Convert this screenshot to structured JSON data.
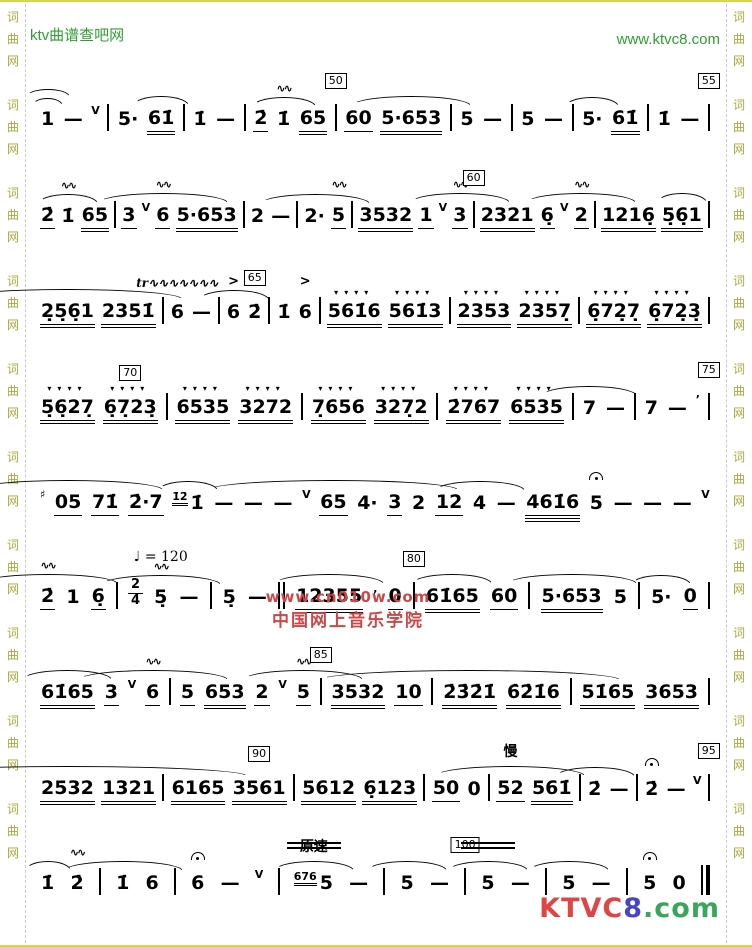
{
  "header": {
    "site_left": "ktv曲谱查吧网",
    "site_right": "www.ktvc8.com",
    "link_color": "#2f9e33"
  },
  "border": {
    "chars": [
      "词",
      "曲",
      "网"
    ],
    "color": "#a8a83e",
    "groups": 10
  },
  "watermark": {
    "line1": "www.cn010w.com",
    "line2": "中国网上音乐学院",
    "color": "#cc4747"
  },
  "logo": {
    "parts": [
      {
        "t": "KTVC",
        "c": "#e04545"
      },
      {
        "t": "8",
        "c": "#4545cc"
      },
      {
        "t": ".",
        "c": "#3aa55c"
      },
      {
        "t": "com",
        "c": "#3aa55c"
      }
    ]
  },
  "tempo": {
    "label": "♩ = 120",
    "slow_label": "慢",
    "atempo_label": "原速"
  },
  "music": {
    "line_tops": [
      74,
      171,
      267,
      363,
      458,
      552,
      648,
      744,
      838
    ],
    "lines": [
      [
        {
          "n": "1",
          "o": [
            {
              "k": "arc2",
              "w": 44
            }
          ]
        },
        {
          "n": "—"
        },
        {
          "sup": "V"
        },
        {
          "bar": "|"
        },
        {
          "n": "5·"
        },
        {
          "n": "61̇",
          "u": 2,
          "o": [
            {
              "k": "arc",
              "w": 56
            }
          ]
        },
        {
          "bar": "|"
        },
        {
          "n": "1̇"
        },
        {
          "n": "—"
        },
        {
          "bar": "|"
        },
        {
          "n": "2̇",
          "u": 1
        },
        {
          "n": "1̇",
          "o": [
            {
              "k": "mord"
            },
            {
              "k": "arc",
              "w": 64
            }
          ]
        },
        {
          "n": "65",
          "u": 2
        },
        {
          "bar": "|",
          "o": [
            {
              "k": "box",
              "v": "50"
            }
          ]
        },
        {
          "n": "60",
          "u": 1
        },
        {
          "n": "5·653",
          "u": 2,
          "o": [
            {
              "k": "arc",
              "w": 120
            }
          ]
        },
        {
          "bar": "|"
        },
        {
          "n": "5"
        },
        {
          "n": "—"
        },
        {
          "bar": "|"
        },
        {
          "n": "5"
        },
        {
          "n": "—"
        },
        {
          "bar": "|"
        },
        {
          "n": "5·",
          "o": [
            {
              "k": "arc",
              "w": 54
            }
          ]
        },
        {
          "n": "61̇",
          "u": 2
        },
        {
          "bar": "|"
        },
        {
          "n": "1̇"
        },
        {
          "n": "—"
        },
        {
          "bar": "|",
          "o": [
            {
              "k": "box",
              "v": "55"
            }
          ]
        }
      ],
      [
        {
          "n": "2̇",
          "u": 1
        },
        {
          "n": "1̇",
          "o": [
            {
              "k": "mord"
            },
            {
              "k": "arc",
              "w": 60
            }
          ]
        },
        {
          "n": "65",
          "u": 2
        },
        {
          "bar": "|"
        },
        {
          "n": "3",
          "u": 1
        },
        {
          "sup": "V"
        },
        {
          "n": "6",
          "u": 1,
          "o": [
            {
              "k": "mord"
            },
            {
              "k": "arc",
              "w": 130
            }
          ]
        },
        {
          "n": "5·653",
          "u": 2
        },
        {
          "bar": "|"
        },
        {
          "n": "2"
        },
        {
          "n": "—"
        },
        {
          "bar": "|"
        },
        {
          "n": "2·",
          "o": [
            {
              "k": "arc",
              "w": 110
            }
          ]
        },
        {
          "n": "5",
          "u": 1,
          "o": [
            {
              "k": "mord"
            }
          ]
        },
        {
          "bar": "|"
        },
        {
          "n": "3532",
          "u": 2
        },
        {
          "n": "1",
          "u": 1
        },
        {
          "sup": "V"
        },
        {
          "n": "3",
          "u": 1,
          "o": [
            {
              "k": "mord"
            },
            {
              "k": "arc",
              "w": 100
            }
          ]
        },
        {
          "bar": "|",
          "o": [
            {
              "k": "box",
              "v": "60"
            }
          ]
        },
        {
          "n": "2321",
          "u": 2
        },
        {
          "n": "6̣",
          "u": 1
        },
        {
          "sup": "V"
        },
        {
          "n": "2",
          "u": 1,
          "o": [
            {
              "k": "mord"
            },
            {
              "k": "arc",
              "w": 110
            }
          ]
        },
        {
          "bar": "|"
        },
        {
          "n": "1216̣",
          "u": 2
        },
        {
          "n": "5̣6̣1",
          "u": 2,
          "o": [
            {
              "k": "arc",
              "w": 50
            }
          ]
        },
        {
          "bar": "|"
        }
      ],
      [
        {
          "n": "2̣5̣6̣1",
          "u": 2,
          "o": [
            {
              "k": "arc",
              "w": 230
            }
          ]
        },
        {
          "n": "2351̇",
          "u": 2
        },
        {
          "bar": "|"
        },
        {
          "n": "6",
          "o": [
            {
              "k": "trill"
            }
          ]
        },
        {
          "n": "—"
        },
        {
          "bar": "|"
        },
        {
          "n": "6",
          "o": [
            {
              "k": "acc"
            },
            {
              "k": "arc",
              "w": 70
            }
          ]
        },
        {
          "n": "2̇",
          "o": [
            {
              "k": "box",
              "v": "65"
            }
          ]
        },
        {
          "bar": "|"
        },
        {
          "n": "1̇"
        },
        {
          "n": "6",
          "o": [
            {
              "k": "acc"
            }
          ]
        },
        {
          "bar": "|"
        },
        {
          "n": "561̇6",
          "u": 2,
          "o": [
            {
              "k": "stacc"
            }
          ]
        },
        {
          "n": "561̇3",
          "u": 2,
          "o": [
            {
              "k": "stacc"
            }
          ]
        },
        {
          "bar": "|"
        },
        {
          "n": "2353",
          "u": 2,
          "o": [
            {
              "k": "stacc"
            }
          ]
        },
        {
          "n": "2357̣",
          "u": 2,
          "o": [
            {
              "k": "stacc"
            }
          ]
        },
        {
          "bar": "|"
        },
        {
          "n": "6̣72̣7̣",
          "u": 2,
          "o": [
            {
              "k": "stacc"
            }
          ]
        },
        {
          "n": "6̣72̣3̣",
          "u": 2,
          "o": [
            {
              "k": "stacc"
            }
          ]
        },
        {
          "bar": "|"
        }
      ],
      [
        {
          "n": "5̣6̣27̣",
          "u": 2,
          "o": [
            {
              "k": "stacc"
            }
          ]
        },
        {
          "n": "6̣7̣23̣",
          "u": 2,
          "o": [
            {
              "k": "stacc"
            },
            {
              "k": "box",
              "v": "70"
            }
          ]
        },
        {
          "bar": "|"
        },
        {
          "n": "6535",
          "u": 2,
          "o": [
            {
              "k": "stacc"
            }
          ]
        },
        {
          "n": "3272",
          "u": 2,
          "o": [
            {
              "k": "stacc"
            }
          ]
        },
        {
          "bar": "|"
        },
        {
          "n": "7̣656",
          "u": 2,
          "o": [
            {
              "k": "stacc"
            }
          ]
        },
        {
          "n": "327̣2",
          "u": 2,
          "o": [
            {
              "k": "stacc"
            }
          ]
        },
        {
          "bar": "|"
        },
        {
          "n": "2̇767",
          "u": 2,
          "o": [
            {
              "k": "stacc"
            }
          ]
        },
        {
          "n": "6535",
          "u": 2,
          "o": [
            {
              "k": "stacc"
            }
          ]
        },
        {
          "bar": "|"
        },
        {
          "n": "7",
          "o": [
            {
              "k": "arc",
              "w": 96
            }
          ]
        },
        {
          "n": "—"
        },
        {
          "bar": "|"
        },
        {
          "n": "7"
        },
        {
          "n": "—"
        },
        {
          "sup": "’"
        },
        {
          "bar": "|",
          "o": [
            {
              "k": "box",
              "v": "75"
            }
          ]
        }
      ],
      [
        {
          "sup": "♯"
        },
        {
          "n": "05",
          "u": 1,
          "o": [
            {
              "k": "arc",
              "w": 190
            }
          ]
        },
        {
          "n": "71̇",
          "u": 1
        },
        {
          "n": "2̇·7",
          "u": 1
        },
        {
          "n": "1̇",
          "g": "1̇2̇",
          "o": [
            {
              "k": "arc",
              "w": 60
            }
          ]
        },
        {
          "n": "—"
        },
        {
          "n": "—"
        },
        {
          "n": "—"
        },
        {
          "sup": "V"
        },
        {
          "n": "65",
          "u": 1,
          "o": [
            {
              "k": "arc",
              "w": 250
            }
          ]
        },
        {
          "n": "4·"
        },
        {
          "n": "3",
          "u": 1
        },
        {
          "n": "2"
        },
        {
          "n": "12",
          "u": 1
        },
        {
          "n": "4",
          "o": [
            {
              "k": "arc",
              "w": 90
            }
          ]
        },
        {
          "n": "—"
        },
        {
          "n": "461̇6",
          "u": 3
        },
        {
          "n": "5",
          "o": [
            {
              "k": "ferm"
            }
          ]
        },
        {
          "n": "—"
        },
        {
          "n": "—"
        },
        {
          "n": "—"
        },
        {
          "sup": "V"
        }
      ],
      [
        {
          "n": "2̇",
          "u": 1,
          "o": [
            {
              "k": "mord"
            },
            {
              "k": "arc",
              "w": 140
            }
          ]
        },
        {
          "n": "1"
        },
        {
          "n": "6̣",
          "u": 1
        },
        {
          "bar": "|"
        },
        {
          "frac": [
            "2",
            "4"
          ]
        },
        {
          "n": "5̣",
          "o": [
            {
              "k": "lbl",
              "v": "♩ = 120",
              "cls": "tempo"
            },
            {
              "k": "mord"
            },
            {
              "k": "arc",
              "w": 120
            }
          ]
        },
        {
          "n": "—"
        },
        {
          "bar": "|"
        },
        {
          "n": "5̣"
        },
        {
          "n": "—"
        },
        {
          "bar": "||"
        },
        {
          "n": "12355",
          "u": 2,
          "o": [
            {
              "k": "arc",
              "w": 110
            }
          ]
        },
        {
          "sup": ","
        },
        {
          "n": "0",
          "u": 1
        },
        {
          "bar": "|",
          "o": [
            {
              "k": "box",
              "v": "80"
            }
          ]
        },
        {
          "n": "61̇65",
          "u": 2,
          "o": [
            {
              "k": "arc",
              "w": 80
            }
          ]
        },
        {
          "n": "60",
          "u": 1
        },
        {
          "bar": "|"
        },
        {
          "n": "5·653",
          "u": 2,
          "o": [
            {
              "k": "arc",
              "w": 130
            }
          ]
        },
        {
          "n": "5"
        },
        {
          "bar": "|"
        },
        {
          "n": "5·",
          "o": [
            {
              "k": "arc",
              "w": 60
            }
          ]
        },
        {
          "n": "0",
          "u": 1
        },
        {
          "bar": "|"
        }
      ],
      [
        {
          "n": "61̇65",
          "u": 2,
          "o": [
            {
              "k": "arc",
              "w": 90
            }
          ]
        },
        {
          "n": "3",
          "u": 1
        },
        {
          "sup": "V"
        },
        {
          "n": "6",
          "u": 1,
          "o": [
            {
              "k": "mord"
            },
            {
              "k": "arc",
              "w": 150
            }
          ]
        },
        {
          "bar": "|"
        },
        {
          "n": "5",
          "u": 1
        },
        {
          "n": "653",
          "u": 2
        },
        {
          "n": "2",
          "u": 1
        },
        {
          "sup": "V"
        },
        {
          "n": "5",
          "u": 1,
          "o": [
            {
              "k": "mord"
            },
            {
              "k": "arc",
              "w": 120
            }
          ]
        },
        {
          "bar": "|",
          "o": [
            {
              "k": "box",
              "v": "85"
            }
          ]
        },
        {
          "n": "3532",
          "u": 2
        },
        {
          "n": "10",
          "u": 1
        },
        {
          "bar": "|"
        },
        {
          "n": "2̇3̇2̇1̇",
          "u": 2,
          "o": [
            {
              "k": "arc",
              "w": 300
            }
          ]
        },
        {
          "n": "6̇2̇1̇6",
          "u": 2
        },
        {
          "bar": "|"
        },
        {
          "n": "51̇65",
          "u": 2
        },
        {
          "n": "3653",
          "u": 2
        },
        {
          "bar": "|"
        }
      ],
      [
        {
          "n": "2532",
          "u": 2,
          "o": [
            {
              "k": "arc",
              "w": 360
            }
          ]
        },
        {
          "n": "1321",
          "u": 2
        },
        {
          "bar": "|"
        },
        {
          "n": "6165",
          "u": 2
        },
        {
          "n": "3561",
          "u": 2,
          "o": [
            {
              "k": "box",
              "v": "90"
            }
          ]
        },
        {
          "bar": "|"
        },
        {
          "n": "5612",
          "u": 2
        },
        {
          "n": "6̣123",
          "u": 2
        },
        {
          "bar": "|"
        },
        {
          "n": "50",
          "u": 1
        },
        {
          "n": "0"
        },
        {
          "bar": "|"
        },
        {
          "n": "52",
          "u": 1,
          "o": [
            {
              "k": "lbl",
              "v": "慢"
            },
            {
              "k": "arc",
              "w": 150
            }
          ]
        },
        {
          "n": "561̇",
          "u": 2
        },
        {
          "bar": "|"
        },
        {
          "n": "2̇",
          "o": [
            {
              "k": "arc",
              "w": 80
            }
          ]
        },
        {
          "n": "—"
        },
        {
          "bar": "|"
        },
        {
          "n": "2̇",
          "o": [
            {
              "k": "ferm"
            }
          ]
        },
        {
          "n": "—"
        },
        {
          "sup": "V"
        },
        {
          "bar": "|",
          "o": [
            {
              "k": "box",
              "v": "95"
            }
          ]
        }
      ],
      [
        {
          "n": "1̇",
          "o": [
            {
              "k": "arc",
              "w": 46
            }
          ]
        },
        {
          "n": "2̇",
          "o": [
            {
              "k": "mord"
            }
          ]
        },
        {
          "bar": "|"
        },
        {
          "n": "1̇",
          "o": [
            {
              "k": "arc",
              "w": 120
            }
          ]
        },
        {
          "n": "6"
        },
        {
          "bar": "|"
        },
        {
          "n": "6",
          "o": [
            {
              "k": "ferm"
            }
          ]
        },
        {
          "n": "—"
        },
        {
          "sup": "V"
        },
        {
          "bar": "|"
        },
        {
          "n": "5",
          "g": "676",
          "o": [
            {
              "k": "lbl",
              "v": "原速"
            },
            {
              "k": "dlines"
            },
            {
              "k": "arc",
              "w": 80
            }
          ]
        },
        {
          "n": "—"
        },
        {
          "bar": "|"
        },
        {
          "n": "5",
          "o": [
            {
              "k": "arc",
              "w": 80
            }
          ]
        },
        {
          "n": "—"
        },
        {
          "bar": "|",
          "o": [
            {
              "k": "box",
              "v": "100"
            }
          ]
        },
        {
          "n": "5",
          "o": [
            {
              "k": "dlines"
            },
            {
              "k": "arc",
              "w": 80
            }
          ]
        },
        {
          "n": "—"
        },
        {
          "bar": "|"
        },
        {
          "n": "5",
          "o": [
            {
              "k": "arc",
              "w": 80
            }
          ]
        },
        {
          "n": "—"
        },
        {
          "bar": "|"
        },
        {
          "n": "5",
          "o": [
            {
              "k": "ferm"
            }
          ]
        },
        {
          "n": "0"
        },
        {
          "bar": "end"
        }
      ]
    ]
  }
}
